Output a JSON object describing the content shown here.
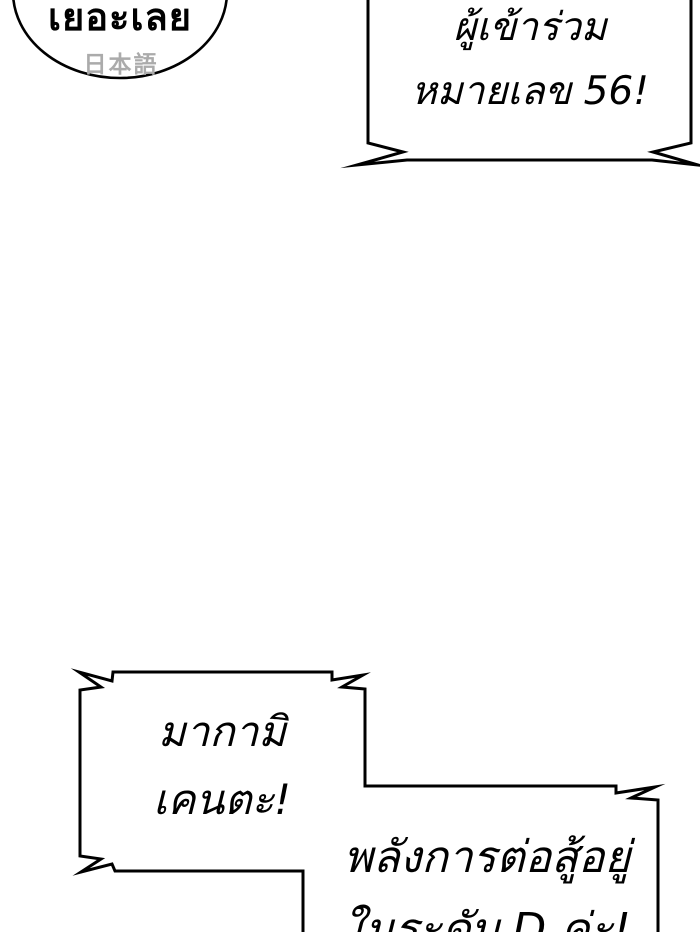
{
  "page": {
    "background": "#ffffff",
    "outline_color": "#000000",
    "subtext_color": "#ababab"
  },
  "bubbles": {
    "oval": {
      "text": "เยอะเลย",
      "subtext": "日本語"
    },
    "top_right_shout": {
      "lines": [
        "ผู้เข้าร่วม",
        "หมายเลข 56!"
      ]
    },
    "bottom_left_shout": {
      "lines": [
        "มากามิ",
        "เคนตะ!"
      ]
    },
    "bottom_right_shout": {
      "lines": [
        "พลังการต่อสู้อยู่",
        "ในระดับ D ค่ะ!"
      ]
    }
  }
}
